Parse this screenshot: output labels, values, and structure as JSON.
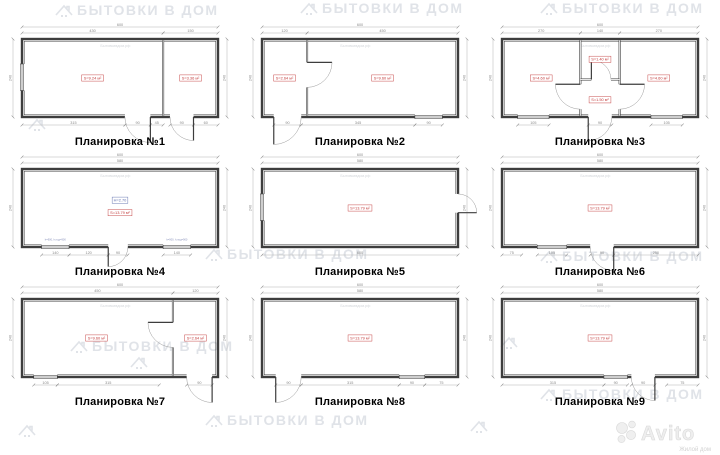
{
  "watermarks": {
    "brand": "БЫТОВКИ В ДОМ",
    "site": "Бытовкивдом.рф",
    "avito": "Avito",
    "avito_sub": "Жилой дом"
  },
  "colors": {
    "wall": "#3d3d3d",
    "dim_line": "#b5b5b5",
    "dim_text": "#8a8a8a",
    "area": "#c23b3b",
    "height": "#5f6fae",
    "arc": "#9a9a9a",
    "note": "#8891bb",
    "site_wm": "#d4d7db"
  },
  "plans": [
    {
      "title": "Планировка №1",
      "dims": {
        "overall_w": "600",
        "left": "240",
        "right": "240",
        "top": [
          {
            "l": "430",
            "f": 0,
            "t": 0.72
          },
          {
            "l": "150",
            "f": 0.72,
            "t": 1
          }
        ],
        "bottom": [
          {
            "l": "315",
            "f": 0,
            "t": 0.525
          },
          {
            "l": "90",
            "f": 0.525,
            "t": 0.655
          },
          {
            "l": "45",
            "f": 0.655,
            "t": 0.72
          },
          {
            "l": "90",
            "f": 0.755,
            "t": 0.875
          },
          {
            "l": "60",
            "f": 0.875,
            "t": 1
          }
        ]
      },
      "vparts": [
        {
          "x": 0.72
        }
      ],
      "hparts": [],
      "rooms": [
        {
          "area": "S=9.24 м²",
          "x": 0.36,
          "y": 0.5
        },
        {
          "area": "S=3.36 м²",
          "x": 0.86,
          "y": 0.5
        }
      ],
      "labels": [],
      "notes": [],
      "doors": [
        {
          "wall": "bottom",
          "a": 0.525,
          "b": 0.655,
          "hinge": "b",
          "out": 1
        },
        {
          "wall": "bottom",
          "a": 0.755,
          "b": 0.875,
          "hinge": "b",
          "out": 1
        }
      ],
      "windows": [
        {
          "wall": "left",
          "a": 0.32,
          "b": 0.66
        }
      ]
    },
    {
      "title": "Планировка №2",
      "dims": {
        "overall_w": "600",
        "left": "240",
        "right": "240",
        "top": [
          {
            "l": "120",
            "f": 0,
            "t": 0.23
          },
          {
            "l": "450",
            "f": 0.23,
            "t": 1
          }
        ],
        "bottom": [
          {
            "l": "90",
            "f": 0.06,
            "t": 0.2
          },
          {
            "l": "345",
            "f": 0.2,
            "t": 0.78
          },
          {
            "l": "90",
            "f": 0.78,
            "t": 0.92
          }
        ]
      },
      "vparts": [
        {
          "x": 0.23
        }
      ],
      "hparts": [],
      "rooms": [
        {
          "area": "S=2.64 м²",
          "x": 0.115,
          "y": 0.5
        },
        {
          "area": "S=9.60 м²",
          "x": 0.615,
          "y": 0.5
        }
      ],
      "labels": [],
      "notes": [],
      "doors": [
        {
          "wall": "bottom",
          "a": 0.06,
          "b": 0.2,
          "hinge": "a",
          "out": 1
        },
        {
          "wall": "vp0",
          "a": 0.3,
          "b": 0.62,
          "hinge": "a",
          "out": 1
        }
      ],
      "windows": [
        {
          "wall": "bottom",
          "a": 0.78,
          "b": 0.92
        }
      ]
    },
    {
      "title": "Планировка №3",
      "dims": {
        "overall_w": "600",
        "left": "240",
        "right": "240",
        "top": [
          {
            "l": "270",
            "f": 0,
            "t": 0.4
          },
          {
            "l": "140",
            "f": 0.4,
            "t": 0.6
          },
          {
            "l": "270",
            "f": 0.6,
            "t": 1
          }
        ],
        "bottom": [
          {
            "l": "105",
            "f": 0.08,
            "t": 0.24
          },
          {
            "l": "90",
            "f": 0.44,
            "t": 0.56
          },
          {
            "l": "105",
            "f": 0.76,
            "t": 0.92
          }
        ]
      },
      "vparts": [
        {
          "x": 0.4
        },
        {
          "x": 0.6
        }
      ],
      "hparts": [
        {
          "y": 0.52,
          "x1": 0.4,
          "x2": 0.6
        }
      ],
      "rooms": [
        {
          "area": "S=4.60 м²",
          "x": 0.2,
          "y": 0.5
        },
        {
          "area": "S=1.40 м²",
          "x": 0.5,
          "y": 0.26
        },
        {
          "area": "S=1.50 м²",
          "x": 0.5,
          "y": 0.78
        },
        {
          "area": "S=4.60 м²",
          "x": 0.8,
          "y": 0.5
        }
      ],
      "labels": [],
      "notes": [],
      "doors": [
        {
          "wall": "bottom",
          "a": 0.44,
          "b": 0.56,
          "hinge": "a",
          "out": 1
        },
        {
          "wall": "vp0",
          "a": 0.58,
          "b": 0.9,
          "hinge": "a",
          "out": -1
        },
        {
          "wall": "vp1",
          "a": 0.58,
          "b": 0.9,
          "hinge": "a",
          "out": 1
        },
        {
          "wall": "hp0",
          "a": 0.28,
          "b": 0.78,
          "hinge": "a",
          "out": 1
        }
      ],
      "windows": [
        {
          "wall": "bottom",
          "a": 0.08,
          "b": 0.24
        },
        {
          "wall": "bottom",
          "a": 0.76,
          "b": 0.92
        }
      ]
    },
    {
      "title": "Планировка №4",
      "dims": {
        "overall_w": "600",
        "left": "240",
        "right": "240",
        "top": [
          {
            "l": "580",
            "f": 0,
            "t": 1
          }
        ],
        "bottom": [
          {
            "l": "140",
            "f": 0.1,
            "t": 0.24
          },
          {
            "l": "120",
            "f": 0.24,
            "t": 0.44
          },
          {
            "l": "90",
            "f": 0.44,
            "t": 0.54
          },
          {
            "l": "140",
            "f": 0.72,
            "t": 0.86
          }
        ]
      },
      "vparts": [],
      "hparts": [],
      "rooms": [
        {
          "area": "S=13.79 м²",
          "x": 0.5,
          "y": 0.56
        }
      ],
      "labels": [
        {
          "l": "H=2.70",
          "x": 0.5,
          "y": 0.4
        }
      ],
      "notes": [
        {
          "l": "h=900, h.под=900",
          "x": 0.17,
          "y": 0.915
        },
        {
          "l": "h=900, h.под=900",
          "x": 0.79,
          "y": 0.915
        }
      ],
      "doors": [
        {
          "wall": "bottom",
          "a": 0.44,
          "b": 0.54,
          "hinge": "a",
          "out": 1
        }
      ],
      "windows": [
        {
          "wall": "bottom",
          "a": 0.1,
          "b": 0.24
        },
        {
          "wall": "bottom",
          "a": 0.72,
          "b": 0.86
        }
      ]
    },
    {
      "title": "Планировка №5",
      "dims": {
        "overall_w": "600",
        "left": "240",
        "right": "240",
        "top": [
          {
            "l": "580",
            "f": 0,
            "t": 1
          }
        ],
        "bottom": [
          {
            "l": "600",
            "f": 0,
            "t": 1
          }
        ]
      },
      "vparts": [],
      "hparts": [],
      "rooms": [
        {
          "area": "S=13.79 м²",
          "x": 0.5,
          "y": 0.5
        }
      ],
      "labels": [],
      "notes": [],
      "doors": [
        {
          "wall": "right",
          "a": 0.32,
          "b": 0.56,
          "hinge": "b",
          "out": 1
        }
      ],
      "windows": [
        {
          "wall": "left",
          "a": 0.32,
          "b": 0.66
        }
      ]
    },
    {
      "title": "Планировка №6",
      "dims": {
        "overall_w": "600",
        "left": "240",
        "right": "240",
        "top": [
          {
            "l": "580",
            "f": 0,
            "t": 1
          }
        ],
        "bottom": [
          {
            "l": "75",
            "f": 0,
            "t": 0.1
          },
          {
            "l": "105",
            "f": 0.18,
            "t": 0.33
          },
          {
            "l": "90",
            "f": 0.45,
            "t": 0.57
          },
          {
            "l": "250",
            "f": 0.57,
            "t": 1
          }
        ]
      },
      "vparts": [],
      "hparts": [],
      "rooms": [
        {
          "area": "S=13.79 м²",
          "x": 0.5,
          "y": 0.5
        }
      ],
      "labels": [],
      "notes": [],
      "doors": [
        {
          "wall": "bottom",
          "a": 0.45,
          "b": 0.57,
          "hinge": "b",
          "out": 1
        }
      ],
      "windows": [
        {
          "wall": "bottom",
          "a": 0.18,
          "b": 0.33
        }
      ]
    },
    {
      "title": "Планировка №7",
      "dims": {
        "overall_w": "600",
        "left": "240",
        "right": "240",
        "top": [
          {
            "l": "450",
            "f": 0,
            "t": 0.77
          },
          {
            "l": "120",
            "f": 0.77,
            "t": 1
          }
        ],
        "bottom": [
          {
            "l": "105",
            "f": 0.06,
            "t": 0.18
          },
          {
            "l": "315",
            "f": 0.18,
            "t": 0.7
          },
          {
            "l": "90",
            "f": 0.84,
            "t": 0.97
          }
        ]
      },
      "vparts": [
        {
          "x": 0.77
        }
      ],
      "hparts": [],
      "rooms": [
        {
          "area": "S=9.60 м²",
          "x": 0.38,
          "y": 0.5
        },
        {
          "area": "S=2.64 м²",
          "x": 0.885,
          "y": 0.5
        }
      ],
      "labels": [],
      "notes": [],
      "doors": [
        {
          "wall": "vp0",
          "a": 0.3,
          "b": 0.62,
          "hinge": "a",
          "out": -1
        },
        {
          "wall": "bottom",
          "a": 0.84,
          "b": 0.97,
          "hinge": "b",
          "out": 1
        }
      ],
      "windows": [
        {
          "wall": "bottom",
          "a": 0.06,
          "b": 0.18
        }
      ]
    },
    {
      "title": "Планировка №8",
      "dims": {
        "overall_w": "600",
        "left": "240",
        "right": "240",
        "top": [
          {
            "l": "580",
            "f": 0,
            "t": 1
          }
        ],
        "bottom": [
          {
            "l": "90",
            "f": 0.07,
            "t": 0.2
          },
          {
            "l": "315",
            "f": 0.2,
            "t": 0.7
          },
          {
            "l": "90",
            "f": 0.7,
            "t": 0.83
          },
          {
            "l": "75",
            "f": 0.83,
            "t": 1
          }
        ]
      },
      "vparts": [],
      "hparts": [],
      "rooms": [
        {
          "area": "S=13.79 м²",
          "x": 0.5,
          "y": 0.5
        }
      ],
      "labels": [],
      "notes": [],
      "doors": [
        {
          "wall": "bottom",
          "a": 0.07,
          "b": 0.2,
          "hinge": "a",
          "out": 1
        }
      ],
      "windows": [
        {
          "wall": "bottom",
          "a": 0.7,
          "b": 0.83
        }
      ]
    },
    {
      "title": "Планировка №9",
      "dims": {
        "overall_w": "600",
        "left": "240",
        "right": "240",
        "top": [
          {
            "l": "580",
            "f": 0,
            "t": 1
          }
        ],
        "bottom": [
          {
            "l": "315",
            "f": 0,
            "t": 0.52
          },
          {
            "l": "90",
            "f": 0.52,
            "t": 0.64
          },
          {
            "l": "90",
            "f": 0.66,
            "t": 0.78
          },
          {
            "l": "75",
            "f": 0.84,
            "t": 1
          }
        ]
      },
      "vparts": [],
      "hparts": [],
      "rooms": [
        {
          "area": "S=13.79 м²",
          "x": 0.5,
          "y": 0.5
        }
      ],
      "labels": [],
      "notes": [],
      "doors": [
        {
          "wall": "bottom",
          "a": 0.66,
          "b": 0.78,
          "hinge": "b",
          "out": 1
        }
      ],
      "windows": [
        {
          "wall": "bottom",
          "a": 0.52,
          "b": 0.64
        }
      ]
    }
  ]
}
